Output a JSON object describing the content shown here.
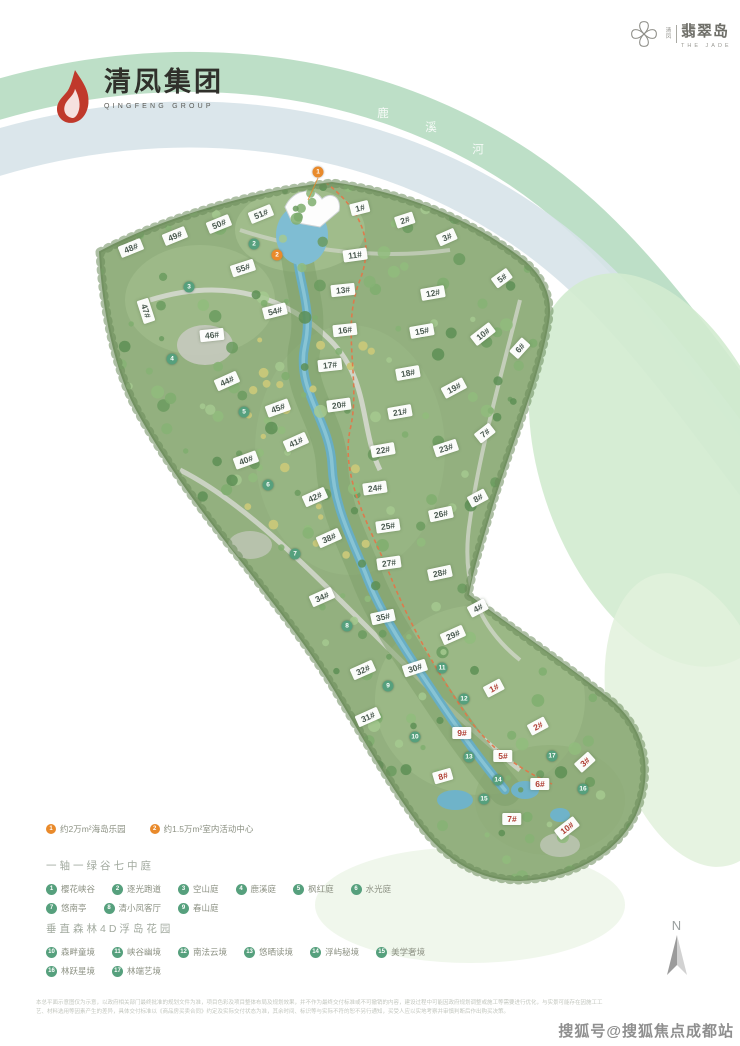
{
  "header": {
    "left_logo": {
      "cn": "清凤集团",
      "en": "QINGFENG GROUP"
    },
    "right_logo": {
      "small": "清凤",
      "cn": "翡翠岛",
      "en": "THE JADE"
    }
  },
  "river_belt": {
    "chars": [
      {
        "ch": "鹿",
        "x": 383,
        "y": 113
      },
      {
        "ch": "溪",
        "x": 431,
        "y": 127
      },
      {
        "ch": "河",
        "x": 478,
        "y": 149
      },
      {
        "ch": "景",
        "x": 546,
        "y": 151
      },
      {
        "ch": "观",
        "x": 577,
        "y": 175
      },
      {
        "ch": "带",
        "x": 604,
        "y": 202
      }
    ]
  },
  "map": {
    "buildings": [
      {
        "t": "48#",
        "x": 131,
        "y": 248,
        "r": -22,
        "c": "dark"
      },
      {
        "t": "49#",
        "x": 175,
        "y": 236,
        "r": -22,
        "c": "dark"
      },
      {
        "t": "50#",
        "x": 219,
        "y": 224,
        "r": -22,
        "c": "dark"
      },
      {
        "t": "51#",
        "x": 261,
        "y": 214,
        "r": -22,
        "c": "dark"
      },
      {
        "t": "55#",
        "x": 243,
        "y": 268,
        "r": -18,
        "c": "dark"
      },
      {
        "t": "54#",
        "x": 275,
        "y": 311,
        "r": -14,
        "c": "dark"
      },
      {
        "t": "47#",
        "x": 146,
        "y": 311,
        "r": 72,
        "c": "dark"
      },
      {
        "t": "46#",
        "x": 212,
        "y": 335,
        "r": -6,
        "c": "dark"
      },
      {
        "t": "44#",
        "x": 227,
        "y": 381,
        "r": -24,
        "c": "dark"
      },
      {
        "t": "45#",
        "x": 278,
        "y": 408,
        "r": -20,
        "c": "dark"
      },
      {
        "t": "40#",
        "x": 246,
        "y": 460,
        "r": -20,
        "c": "dark"
      },
      {
        "t": "41#",
        "x": 296,
        "y": 442,
        "r": -24,
        "c": "dark"
      },
      {
        "t": "42#",
        "x": 315,
        "y": 497,
        "r": -24,
        "c": "dark"
      },
      {
        "t": "38#",
        "x": 329,
        "y": 538,
        "r": -24,
        "c": "dark"
      },
      {
        "t": "34#",
        "x": 322,
        "y": 597,
        "r": -24,
        "c": "dark"
      },
      {
        "t": "32#",
        "x": 363,
        "y": 670,
        "r": -24,
        "c": "dark"
      },
      {
        "t": "31#",
        "x": 368,
        "y": 717,
        "r": -24,
        "c": "dark"
      },
      {
        "t": "35#",
        "x": 383,
        "y": 617,
        "r": -12,
        "c": "dark"
      },
      {
        "t": "30#",
        "x": 415,
        "y": 668,
        "r": -18,
        "c": "dark"
      },
      {
        "t": "29#",
        "x": 453,
        "y": 635,
        "r": -24,
        "c": "dark"
      },
      {
        "t": "1#",
        "x": 360,
        "y": 208,
        "r": -14,
        "c": "dark"
      },
      {
        "t": "2#",
        "x": 405,
        "y": 220,
        "r": -18,
        "c": "dark"
      },
      {
        "t": "3#",
        "x": 447,
        "y": 237,
        "r": -24,
        "c": "dark"
      },
      {
        "t": "5#",
        "x": 502,
        "y": 278,
        "r": -36,
        "c": "dark"
      },
      {
        "t": "11#",
        "x": 355,
        "y": 255,
        "r": -8,
        "c": "dark"
      },
      {
        "t": "13#",
        "x": 343,
        "y": 290,
        "r": -6,
        "c": "dark"
      },
      {
        "t": "16#",
        "x": 345,
        "y": 330,
        "r": -6,
        "c": "dark"
      },
      {
        "t": "17#",
        "x": 330,
        "y": 365,
        "r": -6,
        "c": "dark"
      },
      {
        "t": "20#",
        "x": 339,
        "y": 405,
        "r": -8,
        "c": "dark"
      },
      {
        "t": "12#",
        "x": 433,
        "y": 293,
        "r": -10,
        "c": "dark"
      },
      {
        "t": "15#",
        "x": 422,
        "y": 331,
        "r": -10,
        "c": "dark"
      },
      {
        "t": "18#",
        "x": 408,
        "y": 373,
        "r": -10,
        "c": "dark"
      },
      {
        "t": "21#",
        "x": 400,
        "y": 412,
        "r": -10,
        "c": "dark"
      },
      {
        "t": "22#",
        "x": 383,
        "y": 450,
        "r": -10,
        "c": "dark"
      },
      {
        "t": "24#",
        "x": 375,
        "y": 488,
        "r": -8,
        "c": "dark"
      },
      {
        "t": "25#",
        "x": 388,
        "y": 526,
        "r": -8,
        "c": "dark"
      },
      {
        "t": "27#",
        "x": 389,
        "y": 563,
        "r": -8,
        "c": "dark"
      },
      {
        "t": "10#",
        "x": 483,
        "y": 334,
        "r": -38,
        "c": "dark"
      },
      {
        "t": "19#",
        "x": 454,
        "y": 388,
        "r": -28,
        "c": "dark"
      },
      {
        "t": "23#",
        "x": 446,
        "y": 448,
        "r": -18,
        "c": "dark"
      },
      {
        "t": "26#",
        "x": 441,
        "y": 514,
        "r": -12,
        "c": "dark"
      },
      {
        "t": "28#",
        "x": 440,
        "y": 573,
        "r": -12,
        "c": "dark"
      },
      {
        "t": "6#",
        "x": 520,
        "y": 348,
        "r": -48,
        "c": "dark"
      },
      {
        "t": "7#",
        "x": 485,
        "y": 433,
        "r": -38,
        "c": "dark"
      },
      {
        "t": "8#",
        "x": 478,
        "y": 498,
        "r": -28,
        "c": "dark"
      },
      {
        "t": "4#",
        "x": 478,
        "y": 608,
        "r": -28,
        "c": "dark"
      },
      {
        "t": "1#",
        "x": 494,
        "y": 688,
        "r": -28,
        "c": "red"
      },
      {
        "t": "2#",
        "x": 538,
        "y": 726,
        "r": -28,
        "c": "red"
      },
      {
        "t": "3#",
        "x": 585,
        "y": 762,
        "r": -42,
        "c": "red"
      },
      {
        "t": "5#",
        "x": 503,
        "y": 756,
        "r": 0,
        "c": "red"
      },
      {
        "t": "6#",
        "x": 540,
        "y": 784,
        "r": 0,
        "c": "red"
      },
      {
        "t": "7#",
        "x": 512,
        "y": 819,
        "r": 0,
        "c": "red"
      },
      {
        "t": "8#",
        "x": 443,
        "y": 776,
        "r": -16,
        "c": "red"
      },
      {
        "t": "9#",
        "x": 462,
        "y": 733,
        "r": 0,
        "c": "red"
      },
      {
        "t": "10#",
        "x": 567,
        "y": 828,
        "r": -38,
        "c": "red"
      }
    ],
    "markers": [
      {
        "n": "1",
        "x": 318,
        "y": 172,
        "k": "orange"
      },
      {
        "n": "2",
        "x": 277,
        "y": 255,
        "k": "orange"
      },
      {
        "n": "2",
        "x": 254,
        "y": 244,
        "k": "green"
      },
      {
        "n": "3",
        "x": 189,
        "y": 287,
        "k": "green"
      },
      {
        "n": "4",
        "x": 172,
        "y": 359,
        "k": "green"
      },
      {
        "n": "5",
        "x": 244,
        "y": 412,
        "k": "green"
      },
      {
        "n": "6",
        "x": 268,
        "y": 485,
        "k": "green"
      },
      {
        "n": "7",
        "x": 295,
        "y": 554,
        "k": "green"
      },
      {
        "n": "8",
        "x": 347,
        "y": 626,
        "k": "green"
      },
      {
        "n": "9",
        "x": 388,
        "y": 686,
        "k": "green"
      },
      {
        "n": "10",
        "x": 415,
        "y": 737,
        "k": "green"
      },
      {
        "n": "11",
        "x": 442,
        "y": 668,
        "k": "green"
      },
      {
        "n": "12",
        "x": 464,
        "y": 699,
        "k": "green"
      },
      {
        "n": "13",
        "x": 469,
        "y": 757,
        "k": "green"
      },
      {
        "n": "14",
        "x": 498,
        "y": 780,
        "k": "green"
      },
      {
        "n": "15",
        "x": 484,
        "y": 799,
        "k": "green"
      },
      {
        "n": "16",
        "x": 583,
        "y": 789,
        "k": "green"
      },
      {
        "n": "17",
        "x": 552,
        "y": 756,
        "k": "green"
      }
    ]
  },
  "amenity_legend": [
    {
      "num": "1",
      "label": "约2万m²海岛乐园"
    },
    {
      "num": "2",
      "label": "约1.5万m²室内活动中心"
    }
  ],
  "sections": [
    {
      "title": "一轴一绿谷七中庭",
      "rows": [
        [
          {
            "n": "1",
            "label": "樱花峡谷"
          },
          {
            "n": "2",
            "label": "逐光跑道"
          },
          {
            "n": "3",
            "label": "空山庭"
          },
          {
            "n": "4",
            "label": "鹿溪庭"
          },
          {
            "n": "5",
            "label": "枫红庭"
          },
          {
            "n": "6",
            "label": "水光庭"
          }
        ],
        [
          {
            "n": "7",
            "label": "悠南亭"
          },
          {
            "n": "8",
            "label": "清小凤客厅"
          },
          {
            "n": "9",
            "label": "春山庭"
          }
        ]
      ]
    },
    {
      "title": "垂直森林4D浮岛花园",
      "rows": [
        [
          {
            "n": "10",
            "label": "森畔童境"
          },
          {
            "n": "11",
            "label": "峡谷幽境"
          },
          {
            "n": "12",
            "label": "南法云境"
          },
          {
            "n": "13",
            "label": "悠晒读境"
          },
          {
            "n": "14",
            "label": "浮屿秘境"
          },
          {
            "n": "15",
            "label": "美学奢境"
          }
        ],
        [
          {
            "n": "16",
            "label": "林跃星境"
          },
          {
            "n": "17",
            "label": "林端艺境"
          }
        ]
      ]
    }
  ],
  "compass": {
    "label": "N"
  },
  "disclaimer": {
    "line1": "本总平面示意图仅为示意，以政府相关部门最终批准的规划文件为准，项目色彩及项目整体布局及规划效果，并不作为最终交付标准或不可撤销的内容，建设过程中可能因政府规划调整或施工等需要进行优化，与实景可能存在因施工工",
    "line2": "艺、材料选用等因素产生的差异，具体交付标准以《商品房买卖合同》约定及实际交付状态为准，其余时间、标识等与实际不符的恕不另行通知，买受人应以实地考察并审慎判断后作出购买决策。"
  },
  "watermark": "搜狐号@搜狐焦点成都站",
  "colors": {
    "marker_orange": "#e98a2b",
    "marker_green": "#56a07d",
    "site_green": "#93b07f",
    "water_blue": "#68aec4",
    "label_dark": "#4a5a50",
    "label_red": "#b03f34"
  }
}
